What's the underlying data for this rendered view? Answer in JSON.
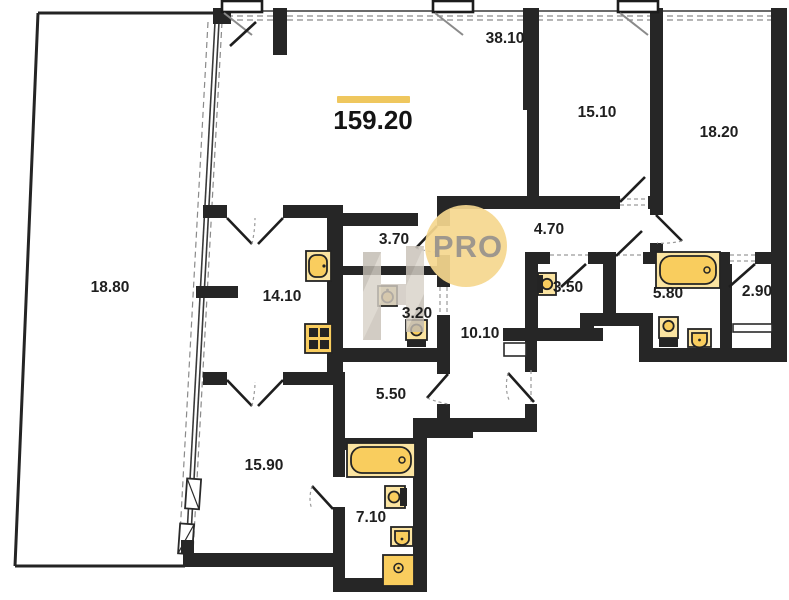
{
  "plan": {
    "title": "apartment-floor-plan",
    "total_area": "159.20",
    "watermark": "PRO",
    "rooms": [
      {
        "id": "living-room",
        "area": "38.10"
      },
      {
        "id": "bedroom-1",
        "area": "15.10"
      },
      {
        "id": "bedroom-2",
        "area": "18.20"
      },
      {
        "id": "terrace",
        "area": "18.80"
      },
      {
        "id": "kitchen",
        "area": "14.10"
      },
      {
        "id": "corridor-1",
        "area": "3.70"
      },
      {
        "id": "wc-1",
        "area": "3.20"
      },
      {
        "id": "corridor-2",
        "area": "4.70"
      },
      {
        "id": "wc-2",
        "area": "3.50"
      },
      {
        "id": "bathroom-1",
        "area": "5.80"
      },
      {
        "id": "storage",
        "area": "2.90"
      },
      {
        "id": "hallway",
        "area": "10.10"
      },
      {
        "id": "corridor-3",
        "area": "5.50"
      },
      {
        "id": "bedroom-3",
        "area": "15.90"
      },
      {
        "id": "bathroom-2",
        "area": "7.10"
      }
    ],
    "fixtures": [
      "kitchen-sink",
      "stove",
      "sink",
      "toilet",
      "bathtub",
      "shower"
    ],
    "colors": {
      "wall": "#262626",
      "fixture": "#F9CD5E",
      "fixture_rim": "#FBE4A1",
      "accent_bar": "#EFC75E",
      "watermark_circle": "#F5D78E",
      "watermark_text": "#9E978D",
      "background": "#FFFFFF"
    }
  }
}
